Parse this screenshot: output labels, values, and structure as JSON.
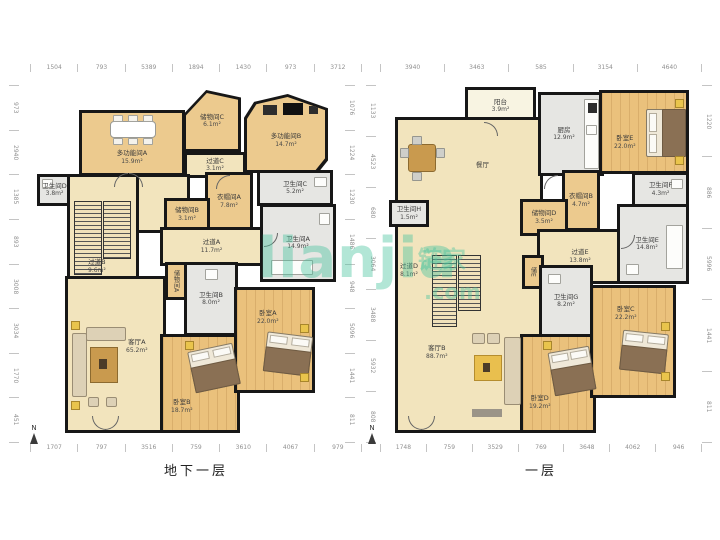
{
  "watermark": {
    "text": "lianjia",
    "cn": "链家",
    "tld": ".com",
    "color": "#48c49e"
  },
  "plans": {
    "basement": {
      "caption": "地下一层",
      "compass": "N",
      "dims_top": [
        "1504",
        "793",
        "5389",
        "1894",
        "1430",
        "973",
        "3712"
      ],
      "dims_bottom": [
        "1707",
        "797",
        "3516",
        "759",
        "3610",
        "4067",
        "979"
      ],
      "dims_left": [
        "973",
        "2940",
        "1385",
        "893",
        "3008",
        "3034",
        "1770",
        "451"
      ],
      "dims_right": [
        "1076",
        "1224",
        "1230",
        "1486",
        "948",
        "5096",
        "1441",
        "811"
      ],
      "rooms": {
        "mf_a": {
          "name": "多功能间A",
          "area": "15.9m²"
        },
        "storage_c": {
          "name": "储物间C",
          "area": "6.1m²"
        },
        "mf_b": {
          "name": "多功能间B",
          "area": "14.7m²"
        },
        "corridor_c": {
          "name": "过道C",
          "area": "3.1m²"
        },
        "bath_d": {
          "name": "卫生间D",
          "area": "3.8m²"
        },
        "corridor_b": {
          "name": "过道B",
          "area": "9.6m²"
        },
        "cloak_a": {
          "name": "衣帽间A",
          "area": "7.8m²"
        },
        "storage_b": {
          "name": "储物间B",
          "area": "3.1m²"
        },
        "bath_c": {
          "name": "卫生间C",
          "area": "5.2m²"
        },
        "bath_a": {
          "name": "卫生间A",
          "area": "14.9m²"
        },
        "corridor_a": {
          "name": "过道A",
          "area": "11.7m²"
        },
        "storage_a": {
          "name": "储物间A",
          "area": ""
        },
        "bath_b": {
          "name": "卫生间B",
          "area": "8.0m²"
        },
        "living_a": {
          "name": "客厅A",
          "area": "65.2m²"
        },
        "bed_b": {
          "name": "卧室B",
          "area": "18.7m²"
        },
        "bed_a": {
          "name": "卧室A",
          "area": "22.0m²"
        }
      }
    },
    "first": {
      "caption": "一层",
      "compass": "N",
      "dims_top": [
        "3940",
        "3463",
        "585",
        "3154",
        "4640"
      ],
      "dims_bottom": [
        "1748",
        "759",
        "3529",
        "769",
        "3648",
        "4062",
        "946"
      ],
      "dims_left": [
        "1133",
        "4523",
        "680",
        "3064",
        "3488",
        "5932",
        "808"
      ],
      "dims_right": [
        "1220",
        "886",
        "5996",
        "1441",
        "811"
      ],
      "rooms": {
        "balcony": {
          "name": "阳台",
          "area": "3.9m²"
        },
        "dining": {
          "name": "餐厅",
          "area": ""
        },
        "kitchen": {
          "name": "厨房",
          "area": "12.9m²"
        },
        "bed_e": {
          "name": "卧室E",
          "area": "22.0m²"
        },
        "bath_f": {
          "name": "卫生间F",
          "area": "4.3m²"
        },
        "cloak_b": {
          "name": "衣帽间B",
          "area": "4.7m²"
        },
        "storage_d": {
          "name": "储物间D",
          "area": "3.5m²"
        },
        "bath_h": {
          "name": "卫生间H",
          "area": "1.5m²"
        },
        "corridor_e": {
          "name": "过道E",
          "area": "13.8m²"
        },
        "bath_e": {
          "name": "卫生间E",
          "area": "14.8m²"
        },
        "corridor_d": {
          "name": "过道D",
          "area": "8.1m²"
        },
        "storage_e": {
          "name": "储E",
          "area": ""
        },
        "bath_g": {
          "name": "卫生间G",
          "area": "8.2m²"
        },
        "living_b": {
          "name": "客厅B",
          "area": "88.7m²"
        },
        "bed_d": {
          "name": "卧室D",
          "area": "19.2m²"
        },
        "bed_c": {
          "name": "卧室C",
          "area": "22.2m²"
        }
      }
    }
  },
  "colors": {
    "wall": "#171717",
    "floor_cream": "#f2e4bd",
    "floor_tan": "#ecca8e",
    "floor_wood": "#eac17c",
    "floor_gray": "#e6e6e3",
    "watermark_teal": "#48c49e"
  }
}
